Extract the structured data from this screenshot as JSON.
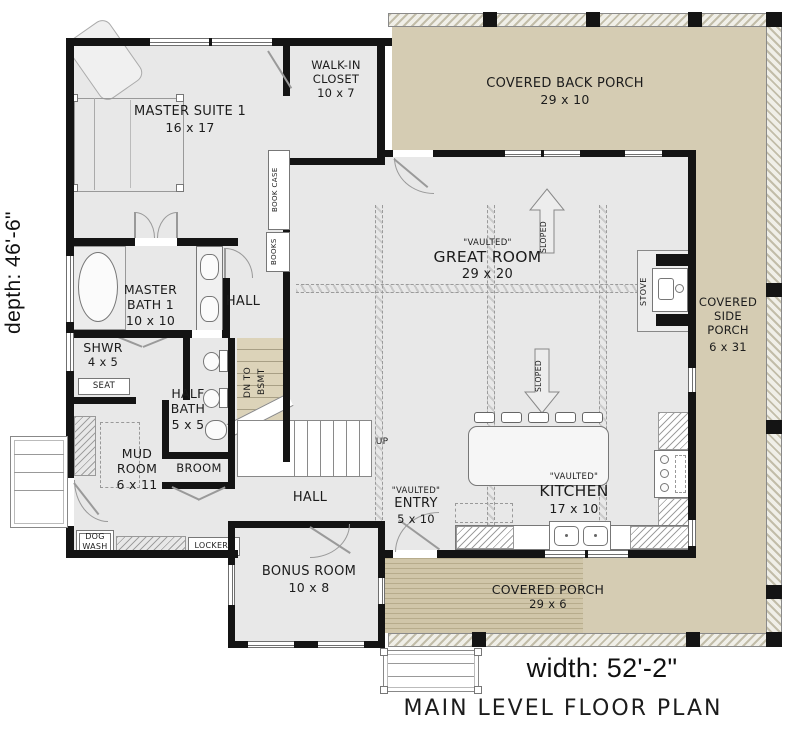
{
  "title": "MAIN LEVEL FLOOR PLAN",
  "dimensions": {
    "depth": "depth: 46'-6\"",
    "width": "width: 52'-2\""
  },
  "rooms": {
    "master_suite": {
      "name": "MASTER SUITE 1",
      "dims": "16 x 17"
    },
    "walk_in_closet": {
      "name_1": "WALK-IN",
      "name_2": "CLOSET",
      "dims": "10 x 7"
    },
    "covered_back_porch": {
      "name": "COVERED BACK PORCH",
      "dims": "29 x 10"
    },
    "great_room": {
      "tag": "\"VAULTED\"",
      "name": "GREAT ROOM",
      "dims": "29 x 20"
    },
    "covered_side_porch": {
      "name_1": "COVERED",
      "name_2": "SIDE",
      "name_3": "PORCH",
      "dims": "6 x 31"
    },
    "master_bath": {
      "name_1": "MASTER",
      "name_2": "BATH 1",
      "dims": "10 x 10"
    },
    "hall_upper": {
      "name": "HALL"
    },
    "shower": {
      "name": "SHWR",
      "dims": "4 x 5",
      "seat": "SEAT"
    },
    "half_bath": {
      "name_1": "HALF",
      "name_2": "BATH",
      "dims": "5 x 5"
    },
    "mud_room": {
      "name_1": "MUD",
      "name_2": "ROOM",
      "dims": "6 x 11"
    },
    "broom": {
      "name": "BROOM"
    },
    "hall_lower": {
      "name": "HALL"
    },
    "entry": {
      "tag": "\"VAULTED\"",
      "name": "ENTRY",
      "dims": "5 x 10"
    },
    "kitchen": {
      "tag": "\"VAULTED\"",
      "name": "KITCHEN",
      "dims": "17 x 10"
    },
    "bonus_room": {
      "name": "BONUS ROOM",
      "dims": "10 x 8"
    },
    "covered_porch": {
      "name": "COVERED PORCH",
      "dims": "29 x 6"
    }
  },
  "annotations": {
    "book_case": "BOOK CASE",
    "books": "BOOKS",
    "dn_to": "DN TO",
    "bsmt": "BSMT",
    "up": "UP",
    "sloped": "SLOPED",
    "stove": "STOVE",
    "dog": "DOG",
    "wash": "WASH",
    "lockers": "LOCKERS"
  },
  "colors": {
    "wall": "#141414",
    "interior": "#e8e8e8",
    "porch": "#d5ccb3",
    "stair": "#dcd3b9"
  }
}
